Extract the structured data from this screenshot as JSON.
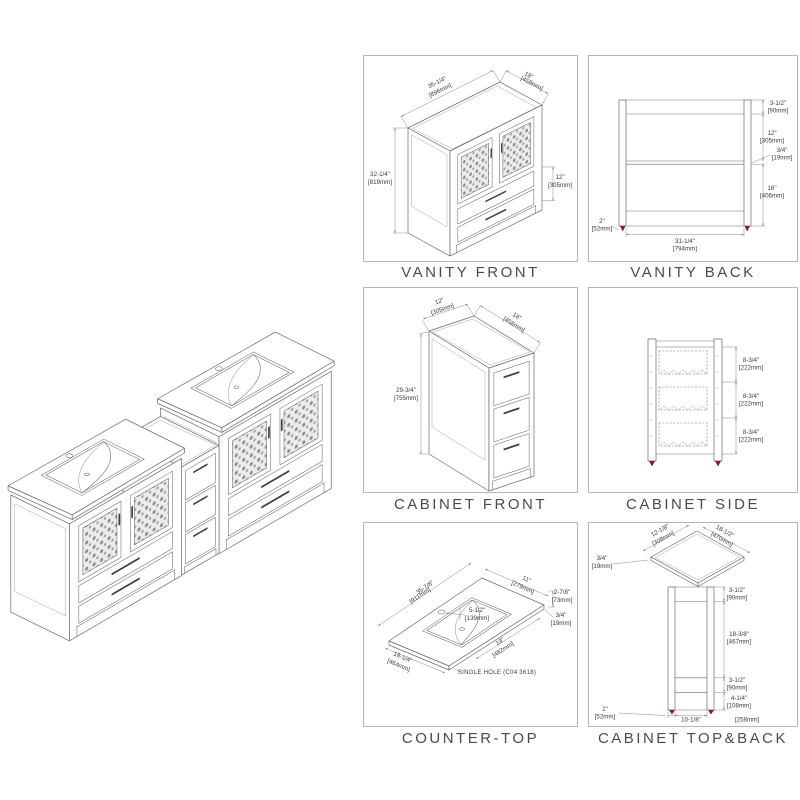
{
  "colors": {
    "background": "#ffffff",
    "line": "#6a6a6a",
    "panel_border": "#b5b5b5",
    "title_text": "#4b4b4b",
    "dim_text": "#3a3a3a",
    "foot_red": "#8b1c1c"
  },
  "panels": {
    "vanity_front": {
      "title": "VANITY FRONT",
      "dims": {
        "width_in": "35-1/4\"",
        "width_mm": "[896mm]",
        "depth_in": "18\"",
        "depth_mm": "[458mm]",
        "height_in": "32-1/4\"",
        "height_mm": "[819mm]",
        "drawers_in": "12\"",
        "drawers_mm": "[305mm]"
      }
    },
    "vanity_back": {
      "title": "VANITY BACK",
      "dims": {
        "toprail_in": "3-1/2\"",
        "toprail_mm": "[90mm]",
        "mid_in": "12\"",
        "mid_mm": "[305mm]",
        "shelf_in": "3/4\"",
        "shelf_mm": "[19mm]",
        "lower_in": "16\"",
        "lower_mm": "[406mm]",
        "leg_in": "2\"",
        "leg_mm": "[52mm]",
        "width_in": "31-1/4\"",
        "width_mm": "[794mm]"
      }
    },
    "cabinet_front": {
      "title": "CABINET FRONT",
      "dims": {
        "width_in": "12\"",
        "width_mm": "[305mm]",
        "depth_in": "18\"",
        "depth_mm": "[458mm]",
        "height_in": "29-3/4\"",
        "height_mm": "[755mm]"
      }
    },
    "cabinet_side": {
      "title": "CABINET SIDE",
      "sections": [
        {
          "in": "8-3/4\"",
          "mm": "[222mm]"
        },
        {
          "in": "8-3/4\"",
          "mm": "[222mm]"
        },
        {
          "in": "8-3/4\"",
          "mm": "[222mm]"
        }
      ]
    },
    "counter_top": {
      "title": "COUNTER-TOP",
      "dims": {
        "length_in": "35-7/8\"",
        "length_mm": "[911mm]",
        "back_in": "11\"",
        "back_mm": "[279mm]",
        "edge_in": "2-7/8\"",
        "edge_mm": "[73mm]",
        "thick_in": "3/4\"",
        "thick_mm": "[19mm]",
        "hole_in": "5-1/2\"",
        "hole_mm": "[139mm]",
        "basin_in": "19\"",
        "basin_mm": "[482mm]",
        "depth_in": "18-1/4\"",
        "depth_mm": "[464mm]"
      },
      "note": "SINGLE HOLE (C04 3618)"
    },
    "cabinet_topback": {
      "title": "CABINET TOP&BACK",
      "top_dims": {
        "width_in": "12-1/8\"",
        "width_mm": "[308mm]",
        "depth_in": "18-1/2\"",
        "depth_mm": "[470mm]",
        "thick_in": "3/4\"",
        "thick_mm": "[19mm]"
      },
      "back_dims": {
        "toprail_in": "3-1/2\"",
        "toprail_mm": "[90mm]",
        "mid_in": "18-3/8\"",
        "mid_mm": "[467mm]",
        "lower_in": "3-1/2\"",
        "lower_mm": "[90mm]",
        "bottom_in": "4-1/4\"",
        "bottom_mm": "[108mm]",
        "leg_in": "2\"",
        "leg_mm": "[52mm]",
        "width_in": "10-1/8\"",
        "width_mm": "[258mm]"
      }
    }
  }
}
